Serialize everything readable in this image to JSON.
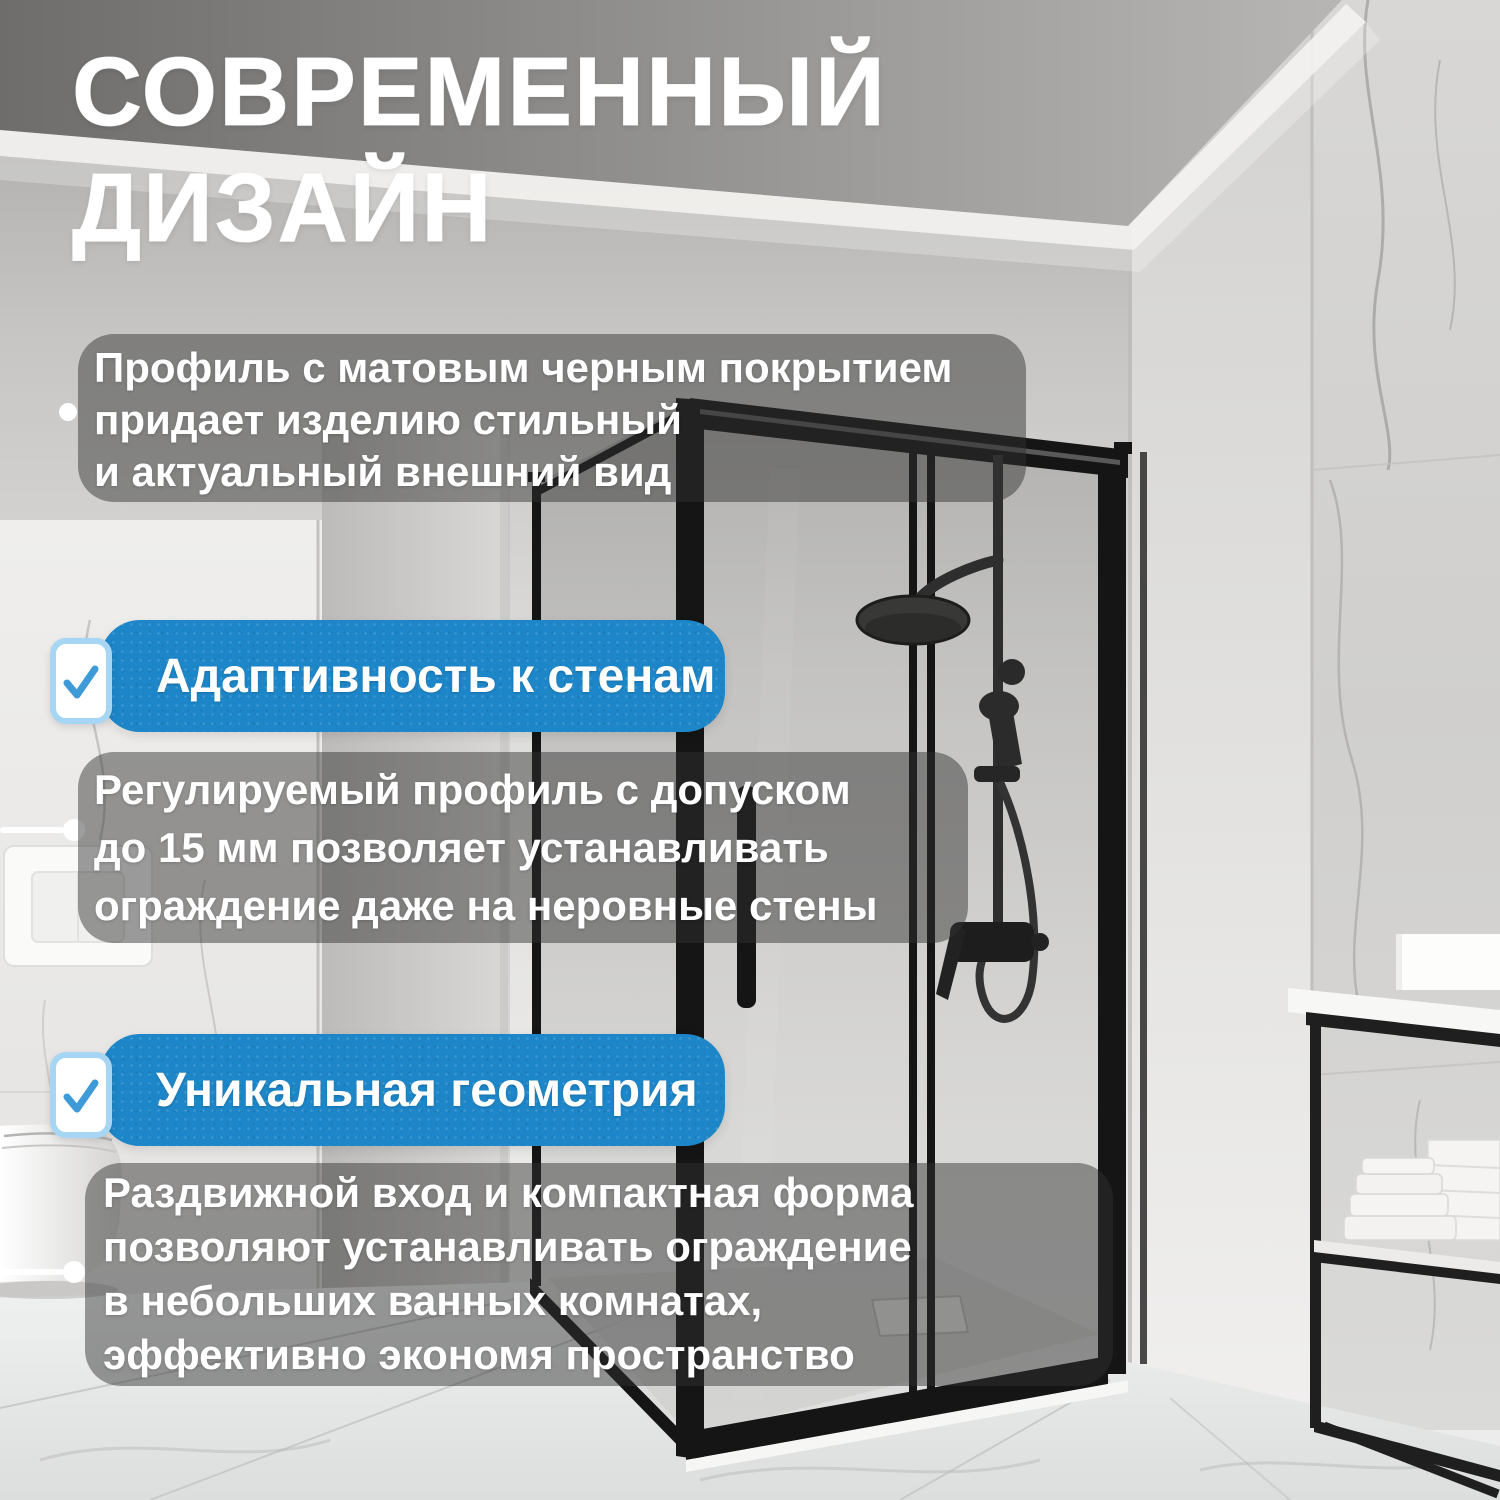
{
  "title": {
    "line1": "СОВРЕМЕННЫЙ",
    "line2": "ДИЗАЙН"
  },
  "feature_intro": {
    "bullet_lines": [
      "Профиль с матовым черным покрытием",
      "придает изделию стильный",
      "и актуальный внешний вид"
    ]
  },
  "feature_adaptivity": {
    "badge": "Адаптивность к стенам",
    "lines": [
      "Регулируемый профиль с допуском",
      "до 15 мм позволяет устанавливать",
      "ограждение даже на неровные стены"
    ]
  },
  "feature_geometry": {
    "badge": "Уникальная геометрия",
    "lines": [
      "Раздвижной вход и компактная форма",
      "позволяют устанавливать ограждение",
      "в небольших ванных комнатах,",
      "эффективно экономя пространство"
    ]
  },
  "icons": {
    "badge_checkbox": "check-icon"
  },
  "colors": {
    "badge_blue": "#1d86c8",
    "checkbox_border": "#a6d6f4",
    "checkmark": "#3e9bd8",
    "overlay": "rgba(50,50,50,0.48)",
    "text": "#ffffff"
  }
}
